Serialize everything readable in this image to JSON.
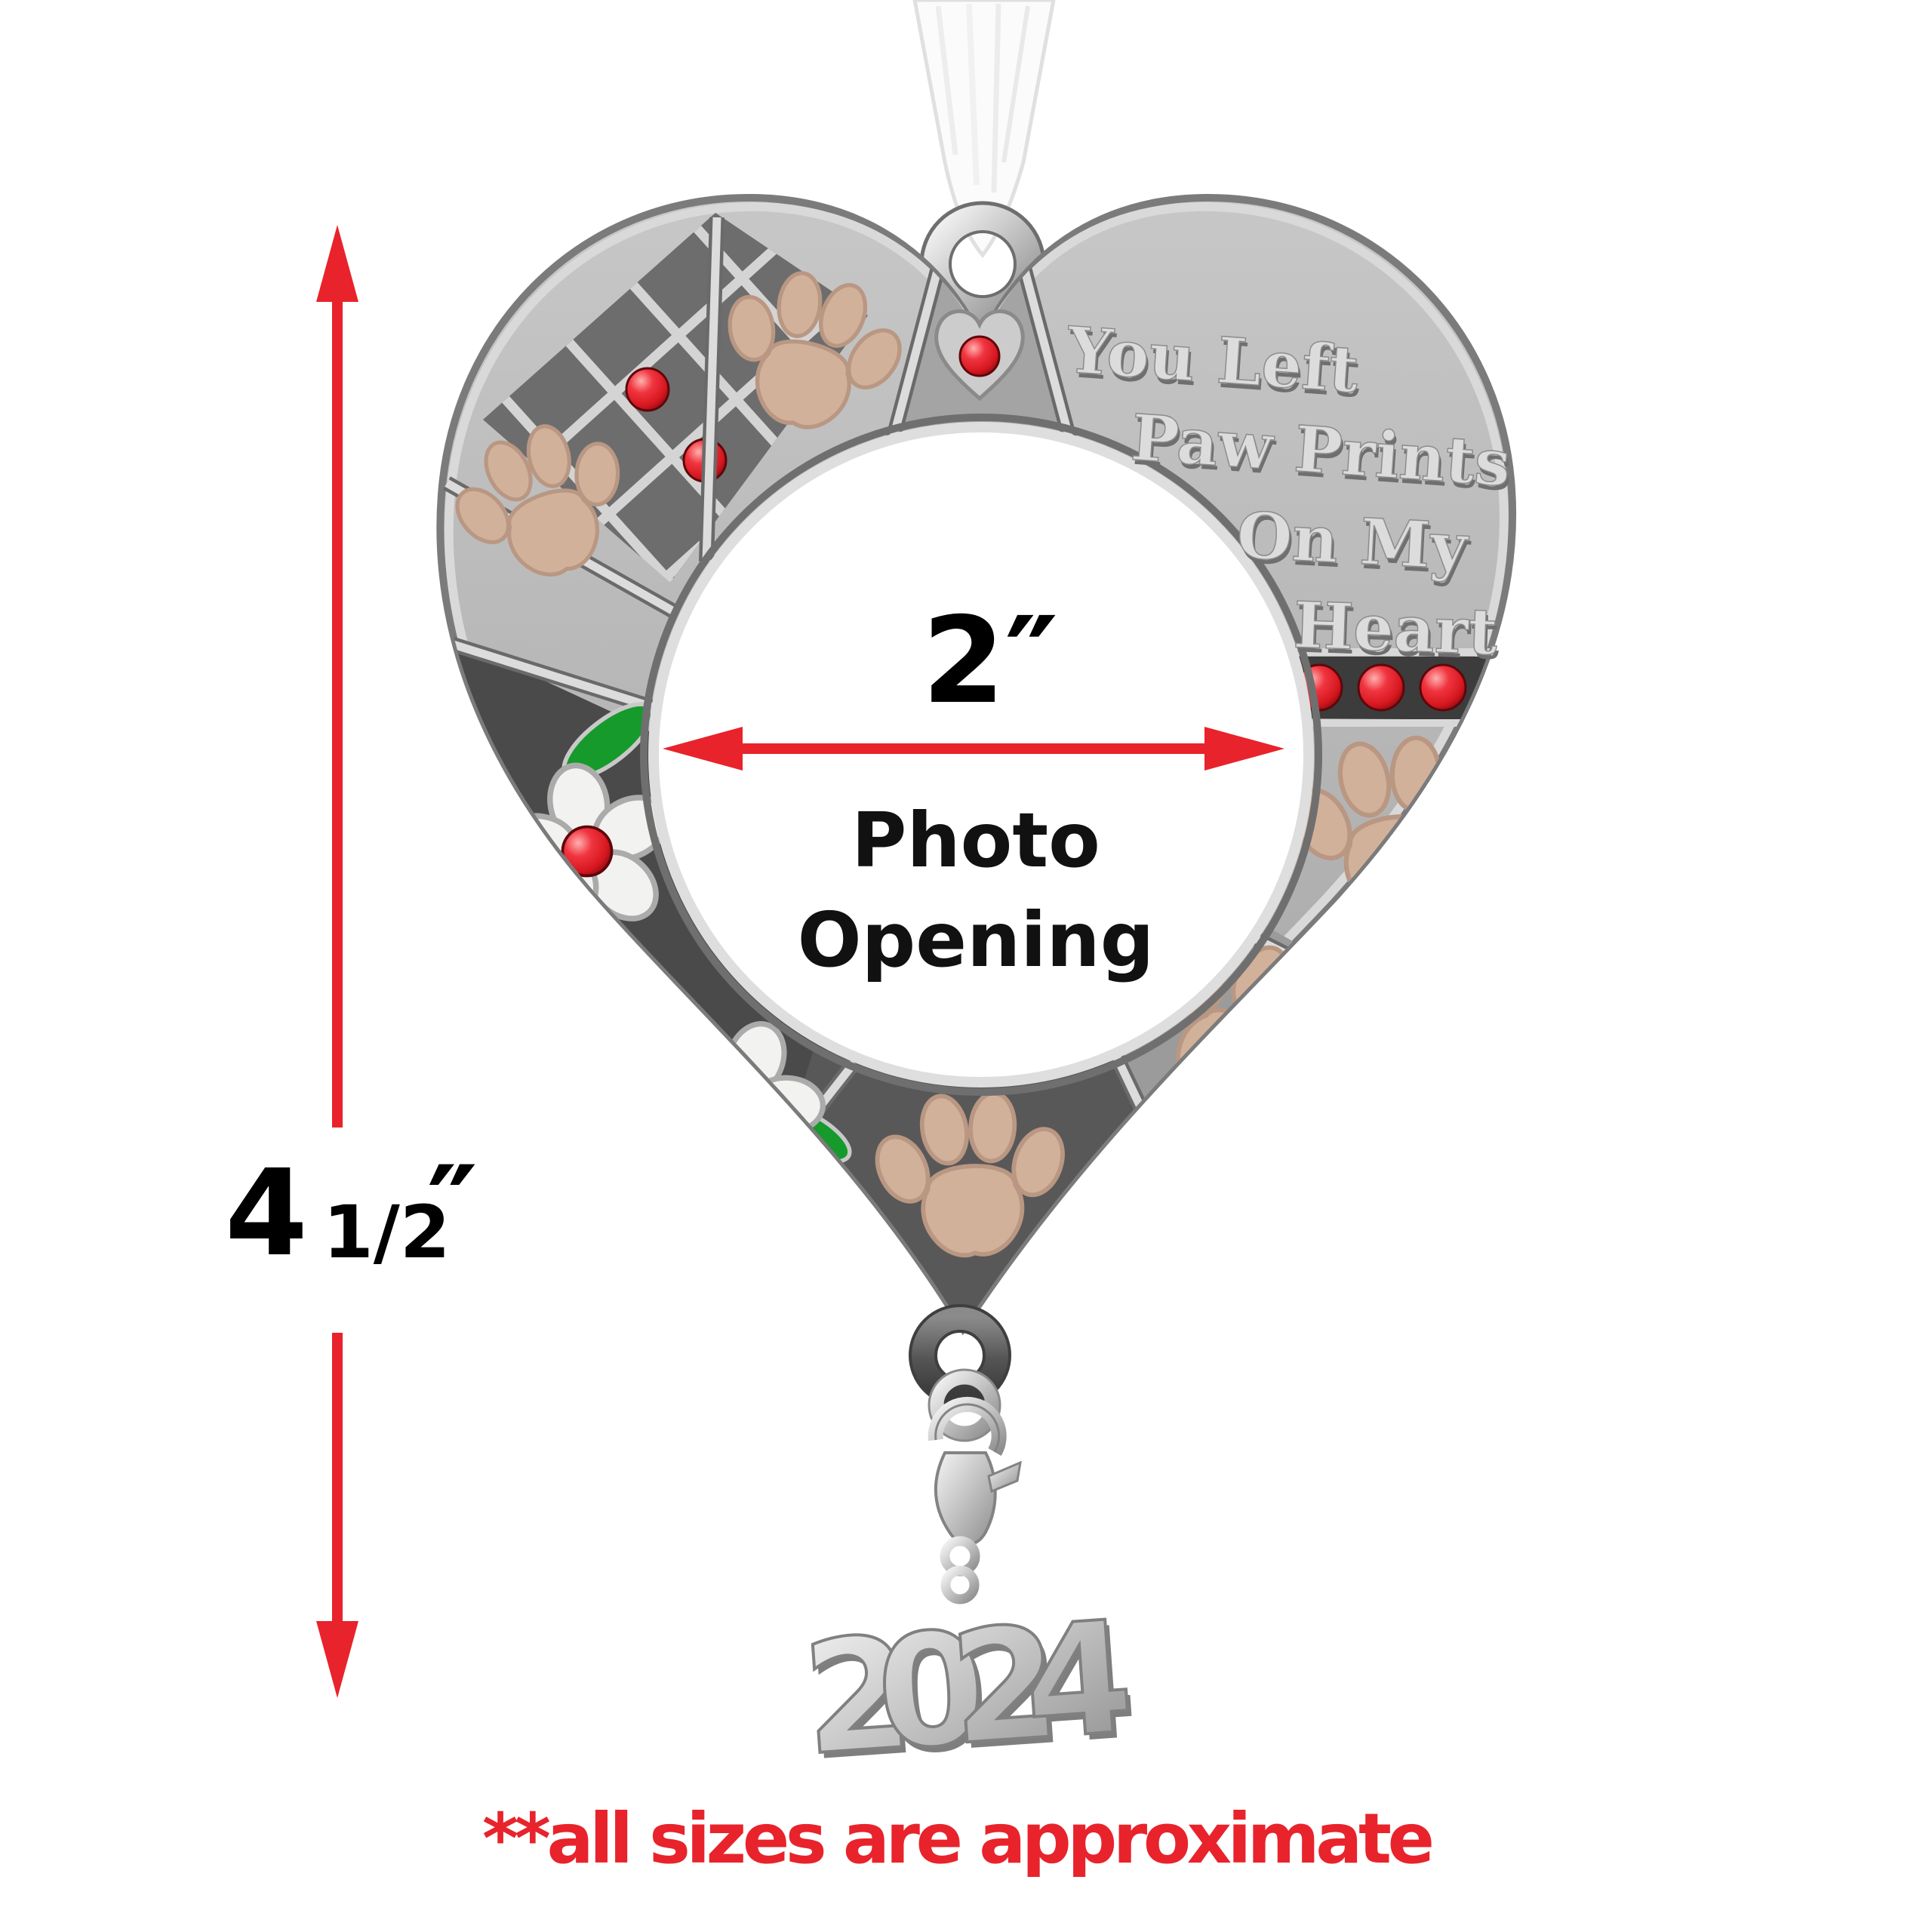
{
  "ornament": {
    "message_line1": "You Left",
    "message_line2": "Paw Prints",
    "message_line3": "On My",
    "message_line4": "Heart",
    "year_charm": "2024"
  },
  "dimensions": {
    "height": {
      "whole": "4",
      "fraction": "1/2",
      "unit": "″"
    },
    "width": {
      "label": "2″"
    },
    "opening": {
      "line1": "Photo",
      "line2": "Opening"
    }
  },
  "footnote": {
    "disclaimer": "**all sizes are approximate"
  },
  "colors": {
    "annotation_red": "#e8232b",
    "crystal_red": "#d5161e",
    "leaf_green": "#169a2b",
    "paw_tan": "#d2b19b",
    "pewter_light": "#c9c9c9",
    "pewter_dark": "#4a4a4a",
    "ribbon_white": "#fbfbfb"
  }
}
